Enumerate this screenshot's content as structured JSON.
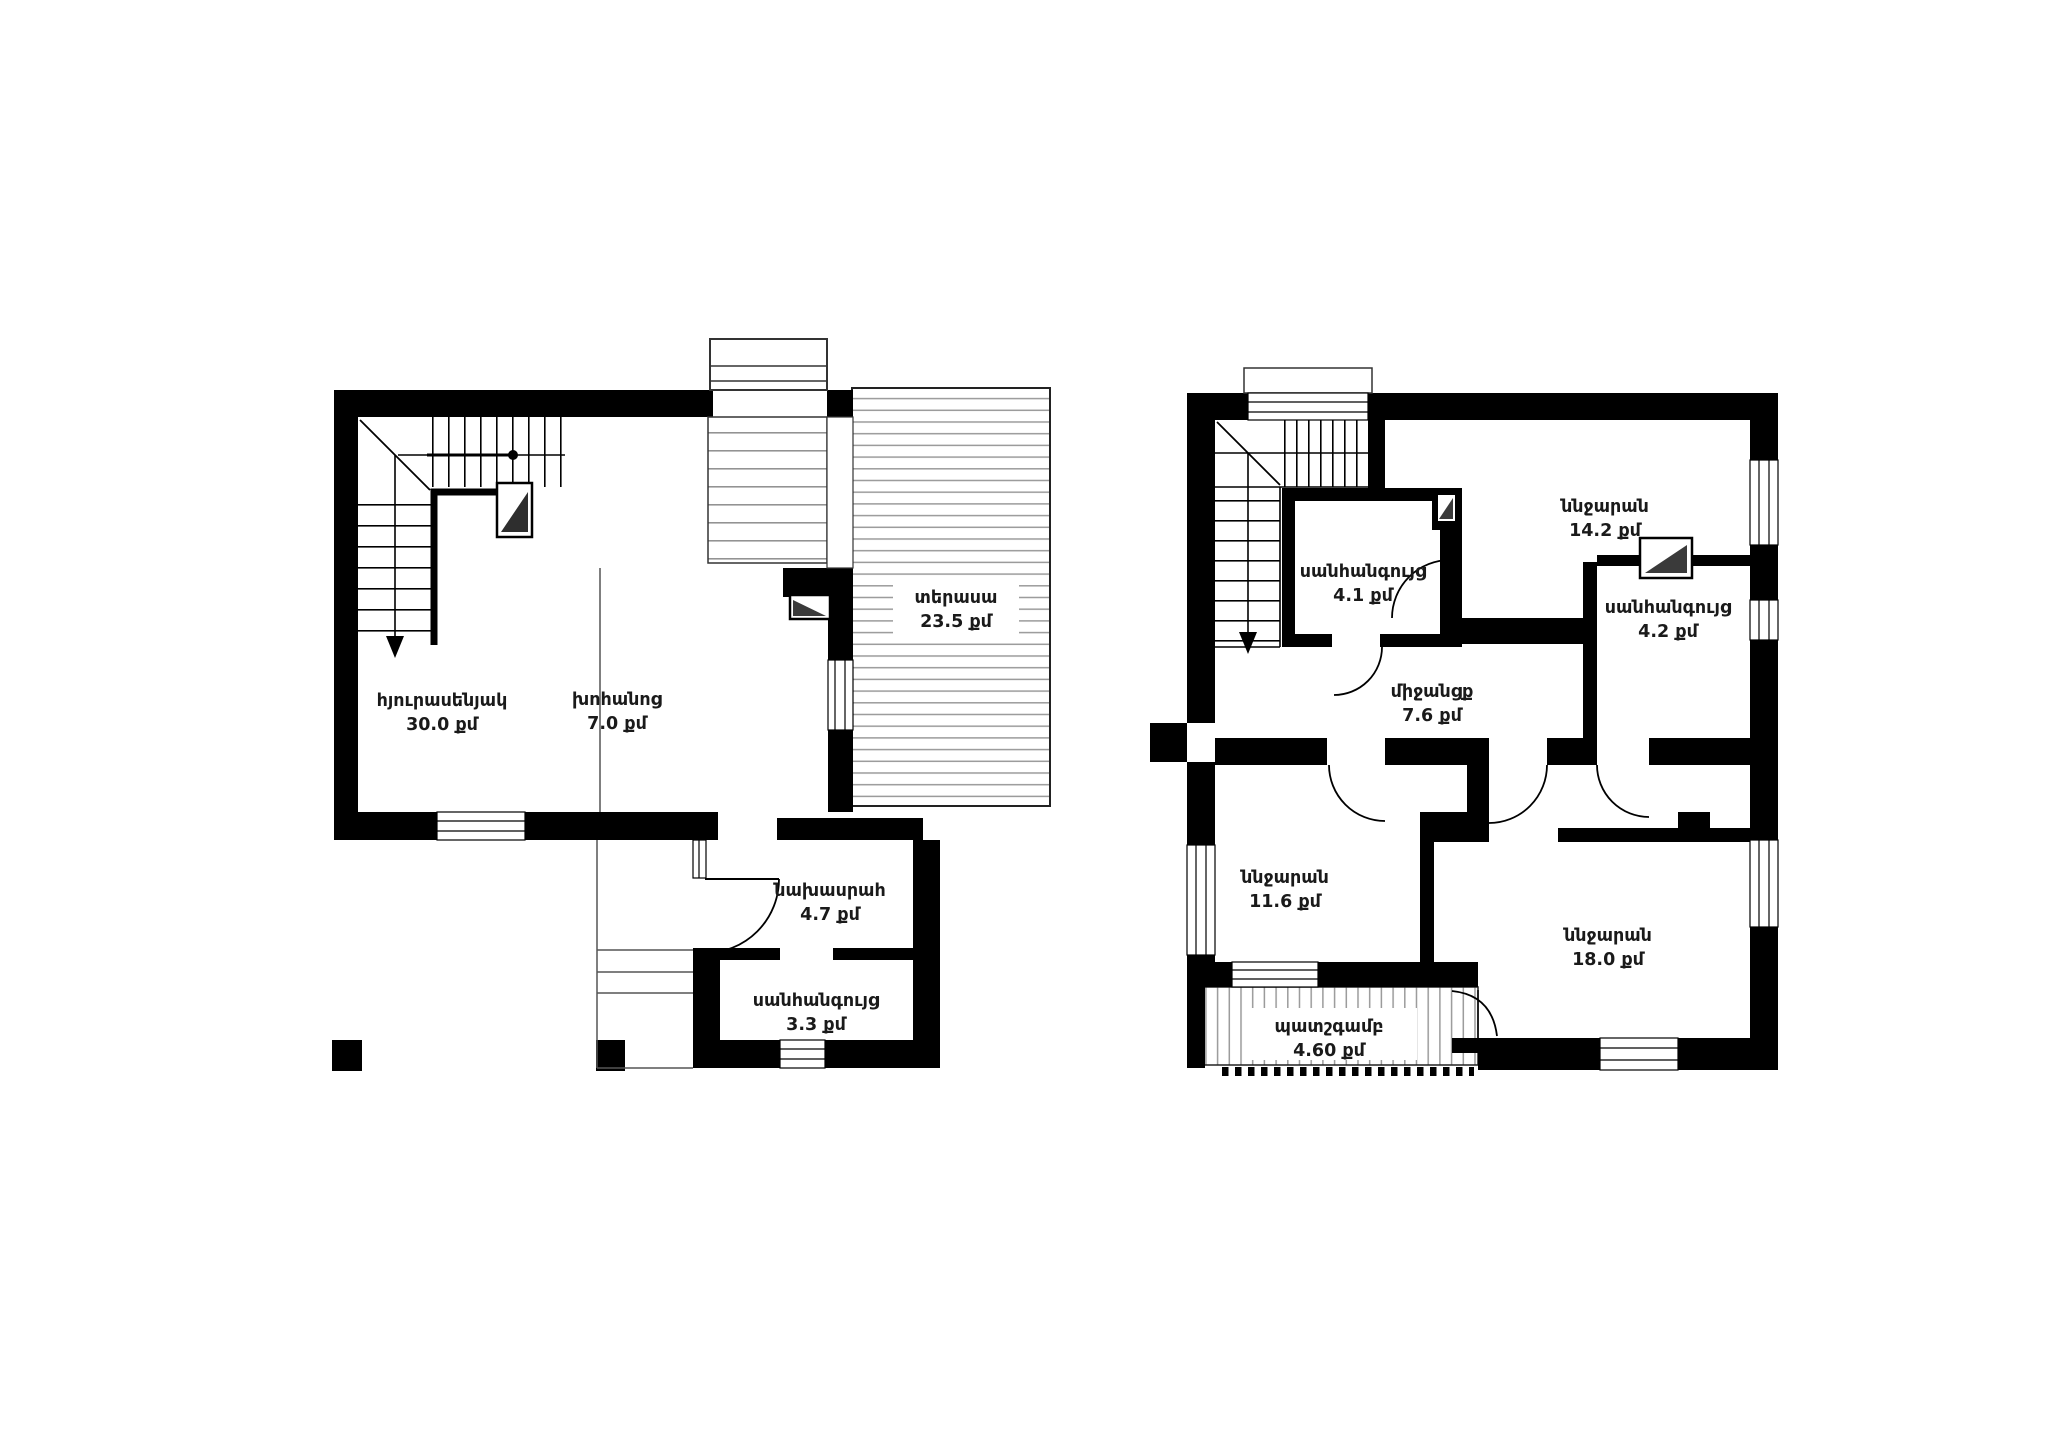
{
  "document": {
    "type": "architectural-floor-plan",
    "background": "#ffffff",
    "wall_color": "#000000",
    "hatch_color": "#9a9a9a",
    "text_color": "#1a1a1a",
    "area_unit": "քմ"
  },
  "plans": [
    {
      "name": "first-floor",
      "rooms": [
        {
          "name": "հյուրասենյակ",
          "area": "30.0 քմ"
        },
        {
          "name": "խոհանոց",
          "area": "7.0 քմ"
        },
        {
          "name": "տերասա",
          "area": "23.5 քմ"
        },
        {
          "name": "նախասրահ",
          "area": "4.7 քմ"
        },
        {
          "name": "սանհանգույց",
          "area": "3.3 քմ"
        }
      ]
    },
    {
      "name": "second-floor",
      "rooms": [
        {
          "name": "ննջարան",
          "area": "14.2 քմ"
        },
        {
          "name": "սանհանգույց",
          "area": "4.1 քմ"
        },
        {
          "name": "միջանցք",
          "area": "7.6 քմ"
        },
        {
          "name": "սանհանգույց",
          "area": "4.2 քմ"
        },
        {
          "name": "ննջարան",
          "area": "11.6 քմ"
        },
        {
          "name": "ննջարան",
          "area": "18.0 քմ"
        },
        {
          "name": "պատշգամբ",
          "area": "4.60 քմ"
        }
      ]
    }
  ]
}
